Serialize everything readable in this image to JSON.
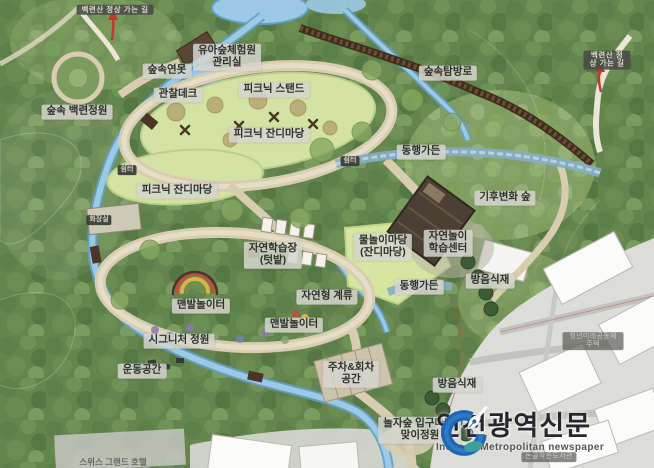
{
  "map": {
    "labels": [
      "백련산 정상 가는 길",
      "백련산 정상 가는 길",
      "유아숲체험원\n관리실",
      "숲속연못",
      "관찰데크",
      "숲속 백련정원",
      "피크닉 스탠드",
      "피크닉 잔디마당",
      "숲속탐방로",
      "동행가든",
      "기후변화 숲",
      "쉼터",
      "쉼터",
      "피크닉 잔디마당",
      "화장실",
      "자연학습장\n(텃밭)",
      "물놀이마당\n(잔디마당)",
      "자연놀이\n학습센터",
      "동행가든",
      "방음식재",
      "자연형 계류",
      "맨발놀이터",
      "맨발놀이터",
      "시그니처 정원",
      "운동공간",
      "주차&회차\n공간",
      "방음식재",
      "놀자숲 입구마당/\n맞이정원",
      "청년미래공동체주택",
      "논골작은도서관",
      "스위스 그랜드 호텔"
    ]
  },
  "logo": {
    "title": "인천광역신문",
    "subtitle": "Incheon Metropolitan newspaper"
  },
  "icons": {
    "logo_icon": "pen-nib-in-blue-circle"
  },
  "colors": {
    "logo_blue": "#1d66b4",
    "logo_teal": "#3da39a",
    "stream": "#9ccae6",
    "lawn": "#d4e3a4",
    "path_tan": "#d8cdb0",
    "boardwalk": "#3f2d1e",
    "urban": "#dcdcd8",
    "arrow_red": "#c0392b"
  }
}
